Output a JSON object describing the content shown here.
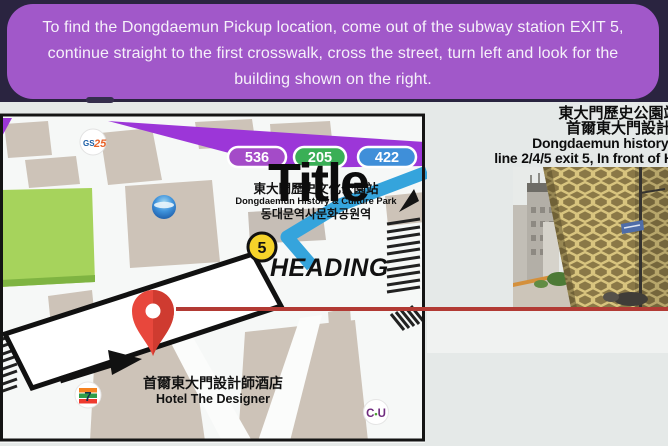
{
  "banner": {
    "lines": [
      "To find the Dongdaemun Pickup location, come out of the subway station EXIT 5,",
      "continue straight to the first crosswalk, cross the street, turn left and look for the",
      "building shown on the right."
    ],
    "bg_color": "#a158c9",
    "text_color": "#f6f1fa"
  },
  "right_panel": {
    "lines": [
      "東大門歷史公園站地鐵站",
      "首爾東大門設計師酒店",
      "Dongdaemun history culture park",
      "line 2/4/5 exit 5, In front of Hotel The Designer"
    ]
  },
  "map": {
    "bus_badges": [
      {
        "label": "536",
        "color": "#a44bc8"
      },
      {
        "label": "205",
        "color": "#3aaf56"
      },
      {
        "label": "422",
        "color": "#3f8fd9"
      }
    ],
    "station": {
      "zh": "東大門歷史文化公園站",
      "en": "Dongdaemun History & Culture Park",
      "ko": "동대문역사문화공원역"
    },
    "exit_number": "5",
    "overlay_title": "Title",
    "overlay_heading": "HEADING",
    "hotel": {
      "zh": "首爾東大門設計師酒店",
      "en": "Hotel The Designer"
    },
    "logos": {
      "gs25_gs": "GS",
      "gs25_25": "25",
      "seven_eleven": "7",
      "cu_c": "C",
      "cu_dot": "•",
      "cu_u": "U"
    }
  },
  "colors": {
    "top_band": "#2a2440",
    "page_bg": "#e5e9e8",
    "road_purple": "#9c36d8",
    "road_blue": "#35a4dc",
    "exit_yellow": "#f5d32a",
    "pin_red": "#e8473c",
    "red_line": "#b23a34",
    "park_green": "#a6d35c",
    "building_beige": "#cdc3b8"
  }
}
